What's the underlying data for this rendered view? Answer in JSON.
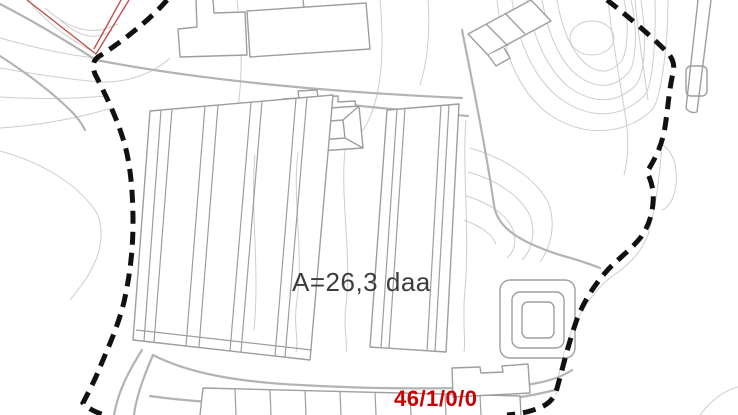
{
  "map": {
    "area_label": "A=26,3 daa",
    "parcel_number": "46/1/0/0"
  },
  "colors": {
    "background": "#ffffff",
    "contour_line": "#cdcdcd",
    "road_line": "#b3b3b3",
    "building_outline": "#9e9e9e",
    "boundary_line": "#111111",
    "marker_red": "#c0504c",
    "area_label_text": "#3d3d3d",
    "parcel_text": "#cc0000"
  }
}
